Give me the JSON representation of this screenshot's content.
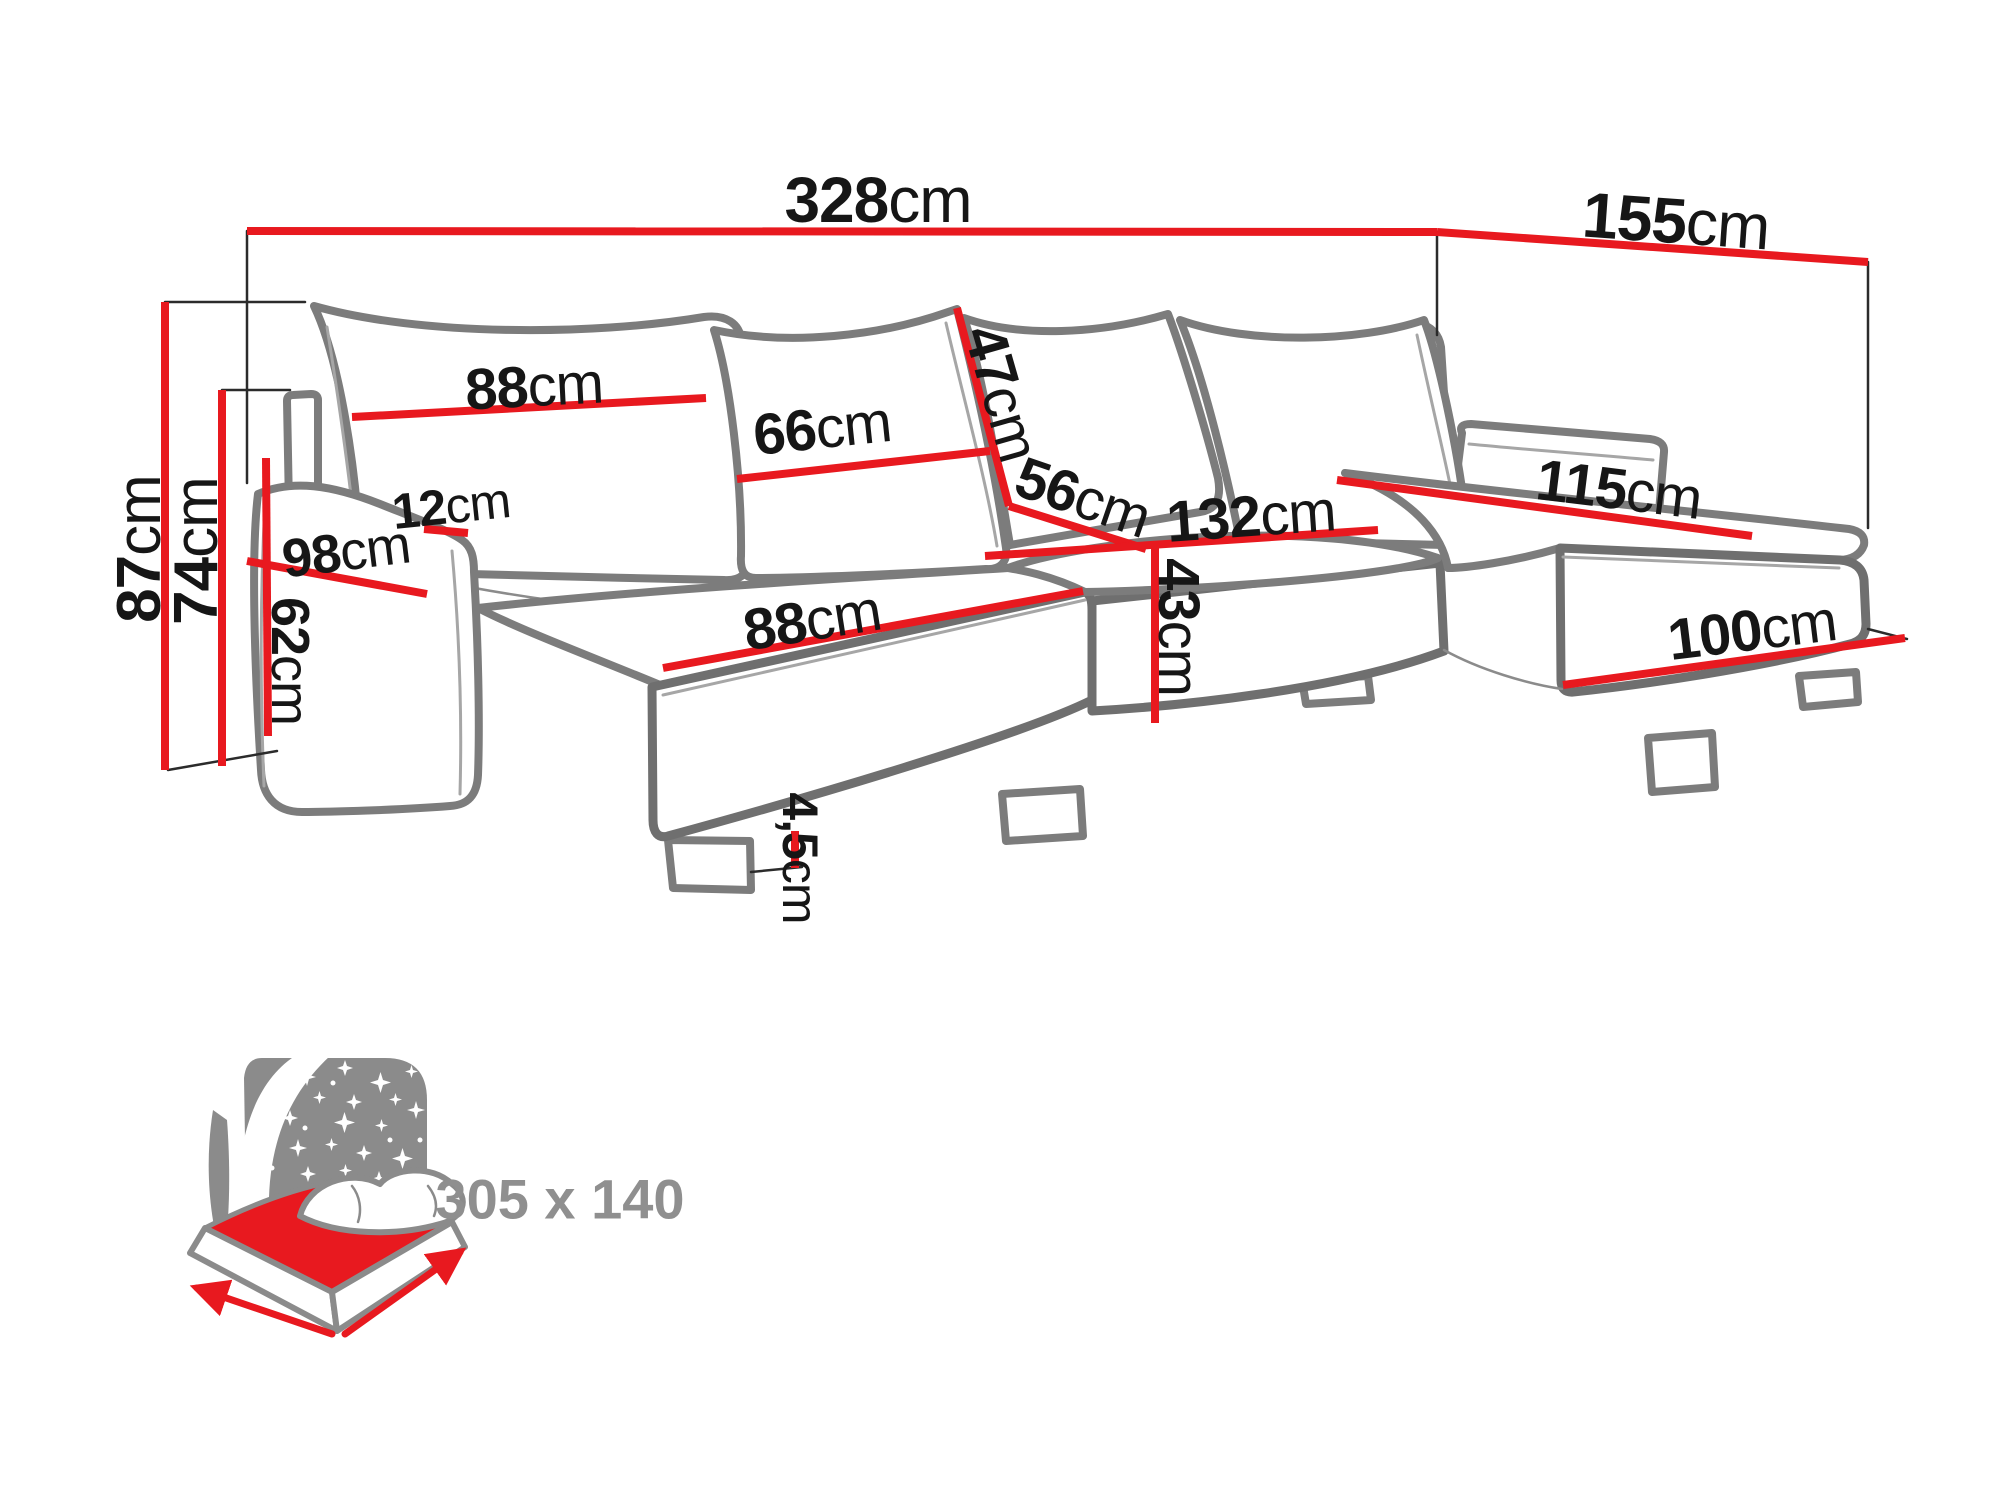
{
  "title": "Corner sofa dimensions diagram",
  "colors": {
    "dimension_red": "#e8191f",
    "outline_gray": "#7c7c7c",
    "label_black": "#161616",
    "icon_gray": "#8b8b8b"
  },
  "dimensions": {
    "total_width": {
      "value": "328",
      "unit": "cm"
    },
    "right_depth": {
      "value": "155",
      "unit": "cm"
    },
    "back_height": {
      "value": "87",
      "unit": "cm"
    },
    "backrest_height": {
      "value": "74",
      "unit": "cm"
    },
    "left_pillow_width": {
      "value": "88",
      "unit": "cm"
    },
    "mid_pillow_width": {
      "value": "66",
      "unit": "cm"
    },
    "pillow_diagonal": {
      "value": "47",
      "unit": "cm"
    },
    "seat_depth": {
      "value": "56",
      "unit": "cm"
    },
    "left_seat_width": {
      "value": "88",
      "unit": "cm"
    },
    "mid_seat_width": {
      "value": "132",
      "unit": "cm"
    },
    "seat_front_height": {
      "value": "43",
      "unit": "cm"
    },
    "right_chaise_length": {
      "value": "115",
      "unit": "cm"
    },
    "right_chaise_width": {
      "value": "100",
      "unit": "cm"
    },
    "arm_top_width": {
      "value": "12",
      "unit": "cm"
    },
    "arm_length": {
      "value": "98",
      "unit": "cm"
    },
    "arm_height": {
      "value": "62",
      "unit": "cm"
    },
    "foot_height": {
      "value": "4,5",
      "unit": "cm"
    }
  },
  "sleeping_area": {
    "label": "305 x 140"
  }
}
